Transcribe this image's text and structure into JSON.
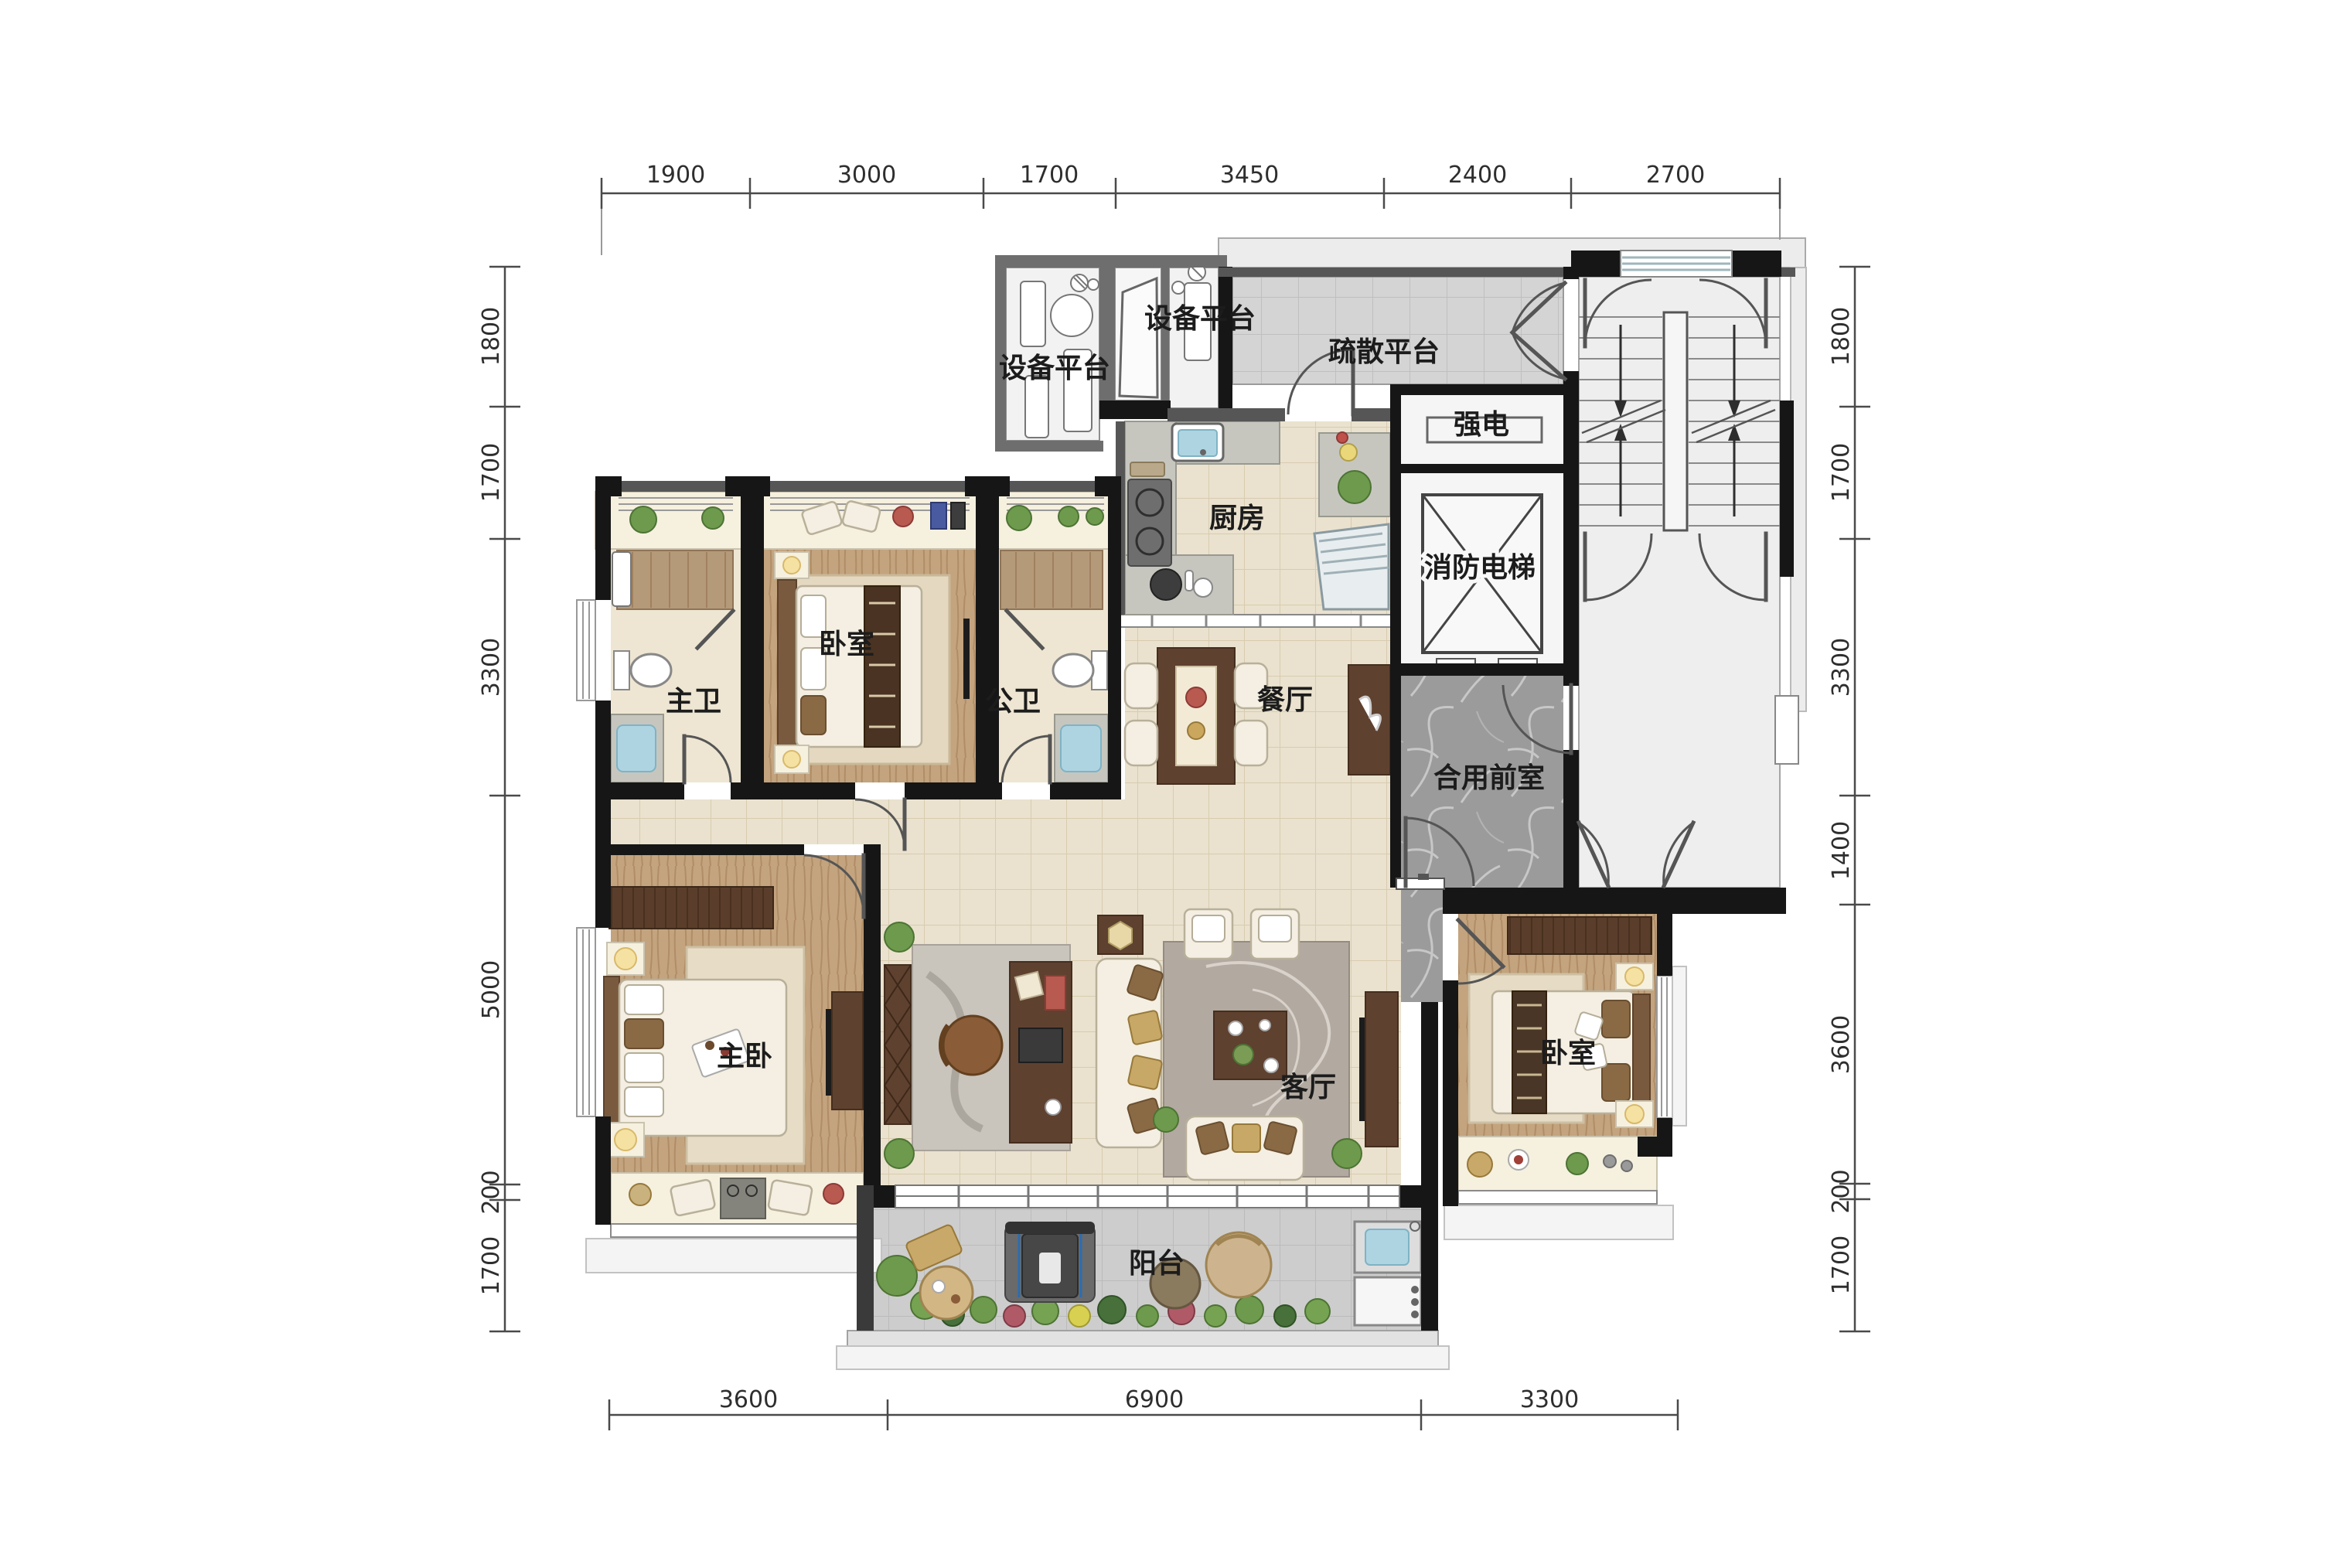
{
  "drawing": {
    "type": "residential-floor-plan",
    "units": "mm",
    "rooms": [
      {
        "id": "equipment-platform-1",
        "label": "设备平台"
      },
      {
        "id": "equipment-platform-2",
        "label": "设备平台"
      },
      {
        "id": "evacuation-platform",
        "label": "疏散平台"
      },
      {
        "id": "strong-electric-room",
        "label": "强电"
      },
      {
        "id": "kitchen",
        "label": "厨房"
      },
      {
        "id": "fire-elevator",
        "label": "消防电梯"
      },
      {
        "id": "bedroom-north",
        "label": "卧室"
      },
      {
        "id": "master-bathroom",
        "label": "主卫"
      },
      {
        "id": "public-bathroom",
        "label": "公卫"
      },
      {
        "id": "dining-room",
        "label": "餐厅"
      },
      {
        "id": "shared-front-room",
        "label": "合用前室"
      },
      {
        "id": "master-bedroom",
        "label": "主卧"
      },
      {
        "id": "living-room",
        "label": "客厅"
      },
      {
        "id": "bedroom-east",
        "label": "卧室"
      },
      {
        "id": "balcony",
        "label": "阳台"
      }
    ],
    "dimensions": {
      "top": [
        "1900",
        "3000",
        "1700",
        "3450",
        "2400",
        "2700"
      ],
      "bottom": [
        "3600",
        "6900",
        "3300"
      ],
      "left": [
        "1800",
        "1700",
        "3300",
        "5000",
        "200",
        "1700"
      ],
      "right": [
        "1800",
        "1700",
        "3300",
        "1400",
        "3600",
        "200",
        "1700"
      ]
    },
    "colors": {
      "wall": "#161616",
      "floor_tile": "#eae2ce",
      "wood": "#c3a47f",
      "marble_lobby": "#9b9b9b",
      "platform_grey": "#d6d6d6",
      "balcony_grey": "#cfcfcf",
      "water": "#aed4e2",
      "greenery": "#6d9a4c",
      "dark_furniture": "#5f4130"
    }
  }
}
